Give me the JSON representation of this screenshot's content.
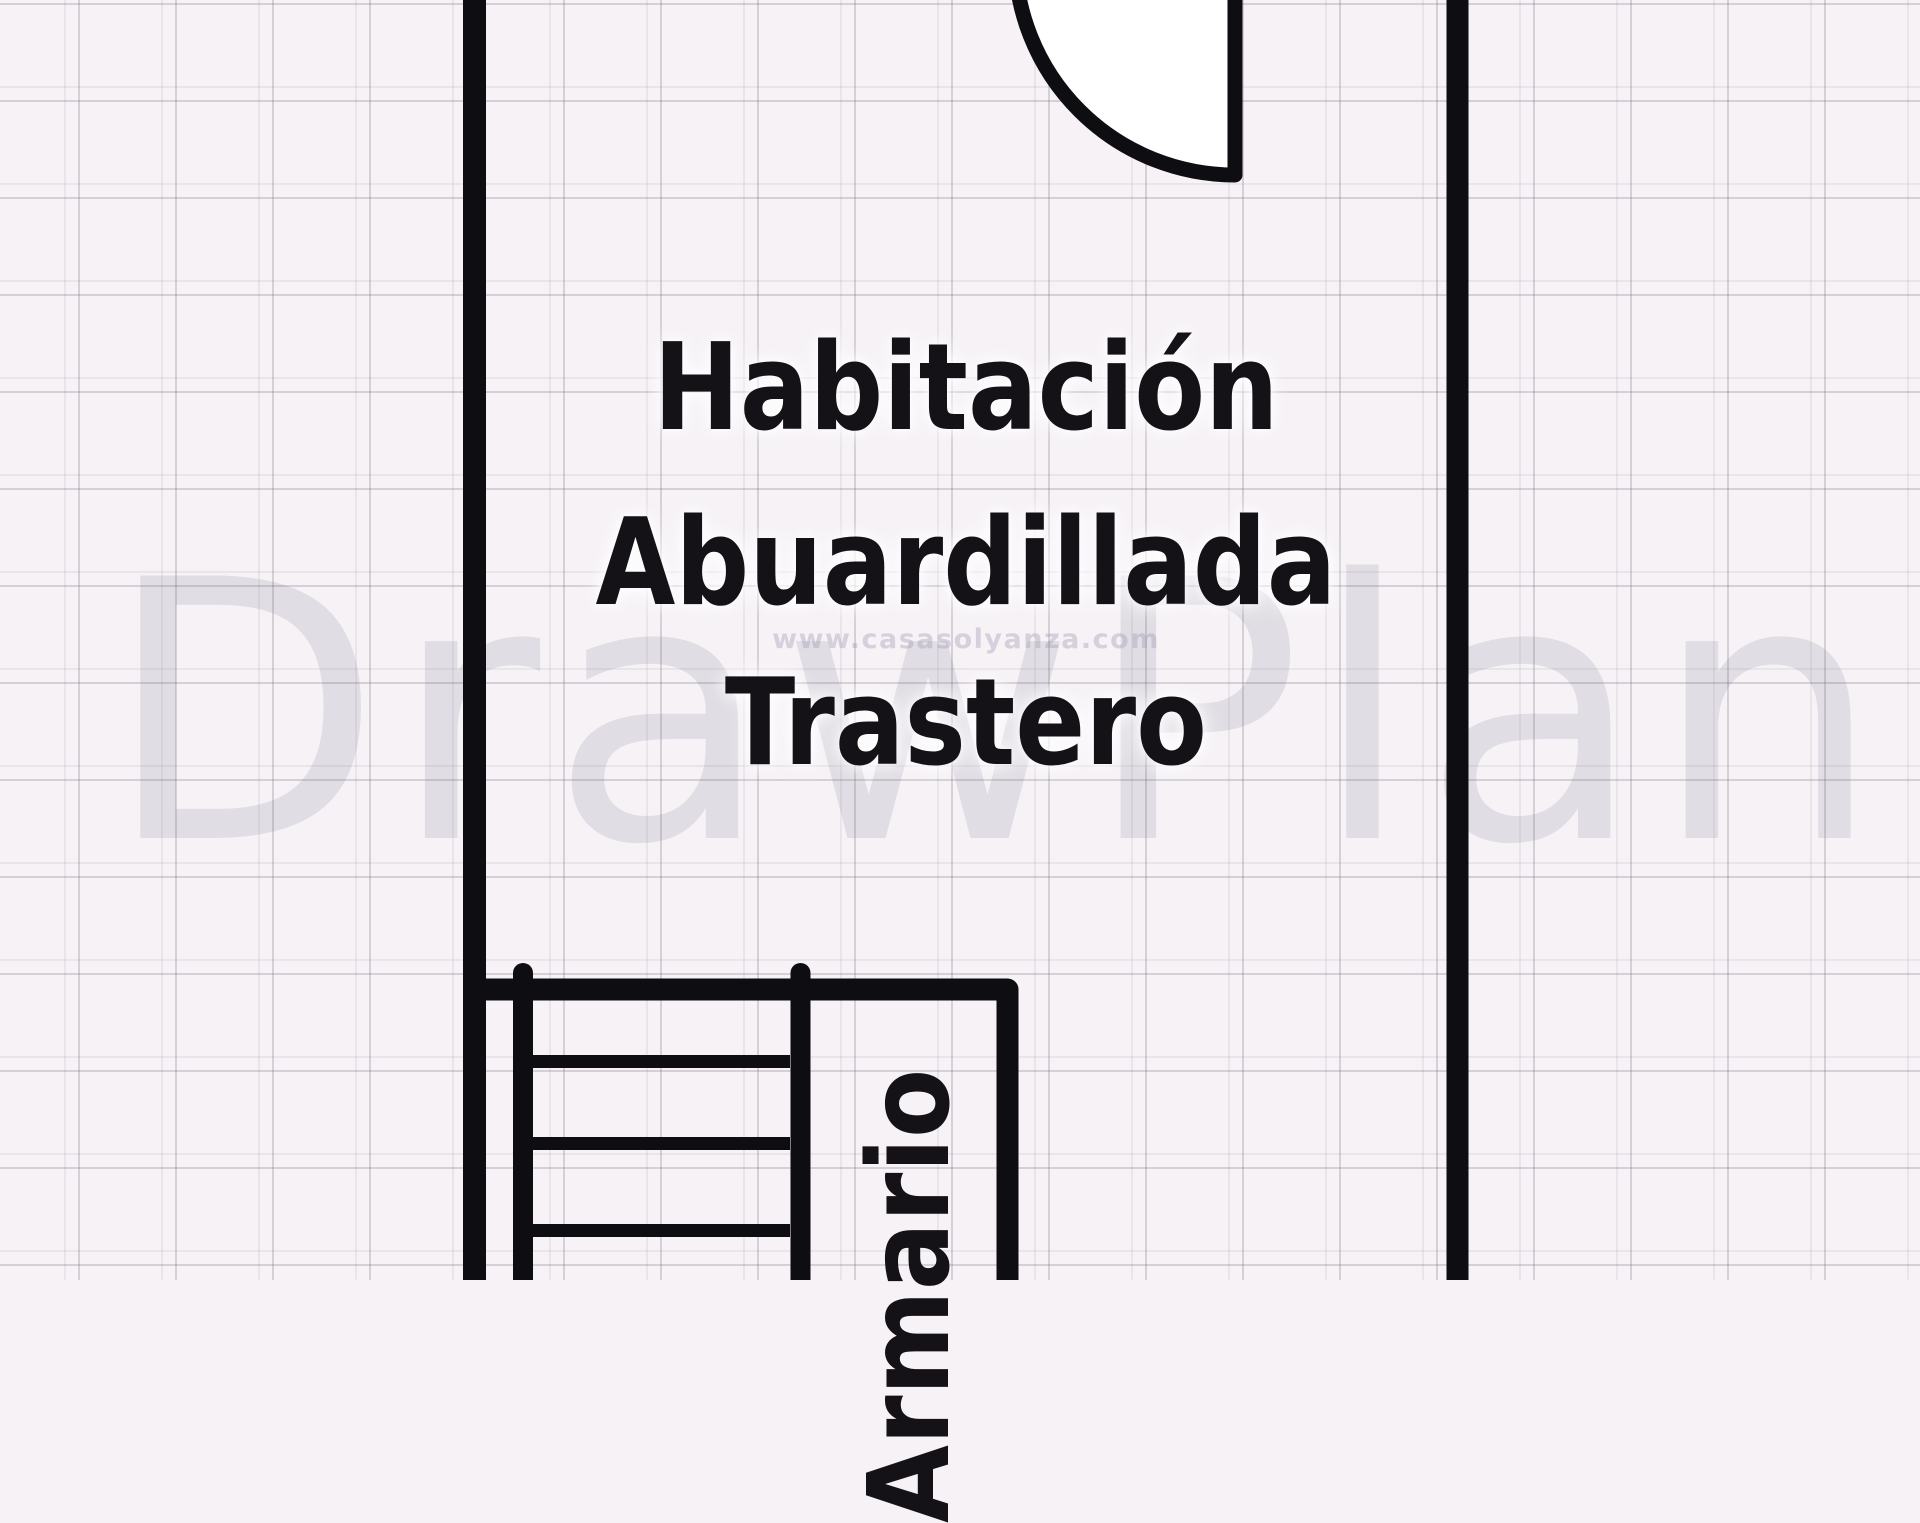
{
  "plan": {
    "type": "floor-plan",
    "room": {
      "label_line1": "Habitación",
      "label_line2": "Abuardillada",
      "label_line3": "Trastero"
    },
    "closet": {
      "label": "Armario",
      "label_visible_part": "ario",
      "label_rotation_deg": -90
    },
    "features": [
      "door-swing-top",
      "staircase-bottom-left",
      "closet-bottom"
    ]
  },
  "watermarks": {
    "brand": "DrawPlan",
    "url": "www.casasolyanza.com"
  },
  "colors": {
    "background": "#f6f2f6",
    "wall": "#0e0d11",
    "grid_major": "#d8d3da",
    "grid_minor": "#eae5eb",
    "door_fill": "#ffffff",
    "label": "#141217",
    "watermark": "#e6e3ea"
  }
}
